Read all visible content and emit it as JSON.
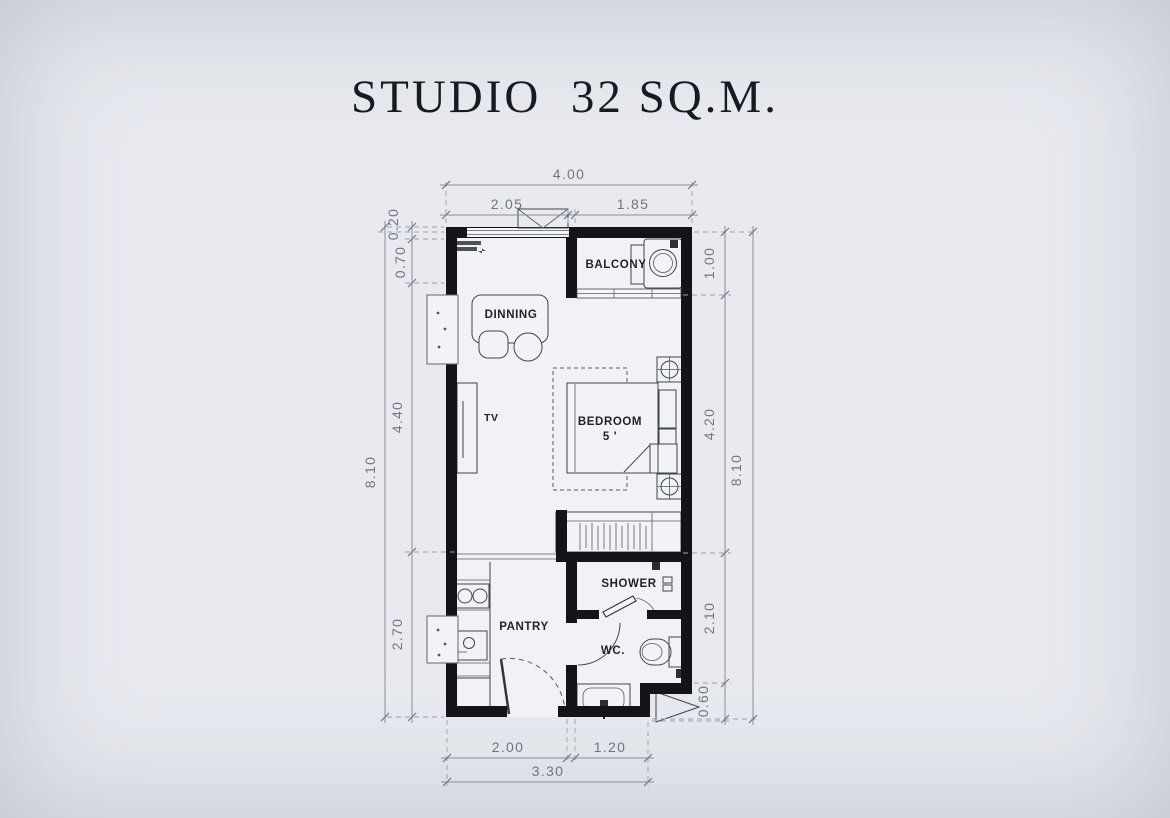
{
  "title": "STUDIO  32 SQ.M.",
  "rooms": {
    "balcony": "BALCONY",
    "dining": "DINNING",
    "tv": "TV",
    "bedroom": "BEDROOM",
    "bedroom_size": "5 '",
    "shower": "SHOWER",
    "pantry": "PANTRY",
    "wc": "WC."
  },
  "dims": {
    "top": {
      "overall": "4.00",
      "segments": [
        "2.05",
        "1.85"
      ]
    },
    "left": {
      "overall": "8.10",
      "segments": [
        "0.20",
        "0.70",
        "4.40",
        "2.70"
      ]
    },
    "right": {
      "overall": "8.10",
      "segments": [
        "1.00",
        "4.20",
        "2.10",
        "0.60"
      ]
    },
    "bottom": {
      "overall": "3.30",
      "segments": [
        "2.00",
        "1.20"
      ]
    }
  },
  "colors": {
    "background": "#e8eaf0",
    "wall": "#131419",
    "furniture_line": "#40454d",
    "dimension_text": "#70757d",
    "label_text": "#1e2126",
    "title_text": "#171a22"
  }
}
